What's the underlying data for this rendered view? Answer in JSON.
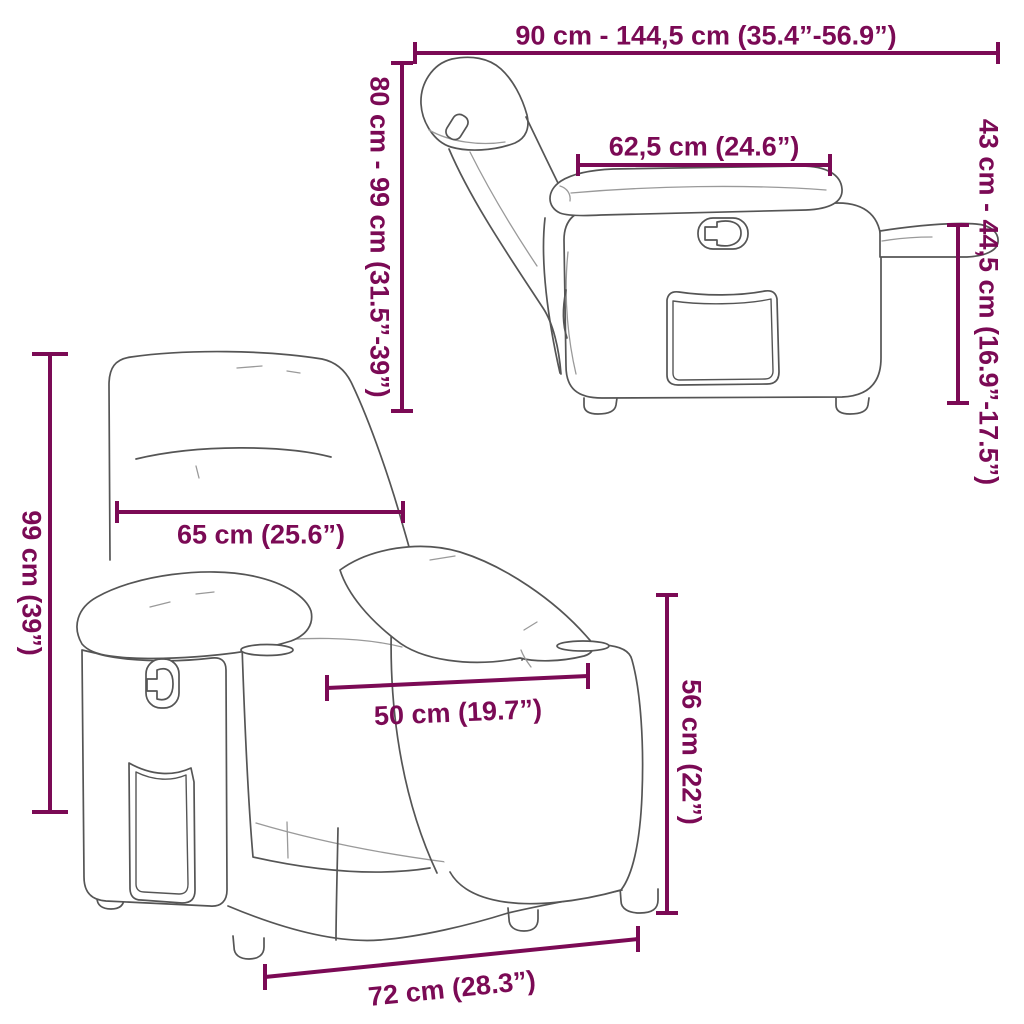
{
  "colors": {
    "accent": "#7B0A55",
    "line_art": "#555555",
    "line_art_light": "#9a9a9a",
    "background": "#FFFFFF"
  },
  "views": {
    "side_reclined": {
      "total_length_label": "90 cm - 144,5 cm (35.4”-56.9”)",
      "backrest_height_label": "80 cm - 99 cm (31.5”-39”)",
      "armrest_depth_label": "62,5 cm (24.6”)",
      "seat_height_label": "43 cm - 44,5 cm (16.9”-17.5”)"
    },
    "front_upright": {
      "total_height_label": "99 cm (39”)",
      "backrest_width_label": "65 cm (25.6”)",
      "seat_width_label": "50 cm (19.7”)",
      "armrest_height_label": "56 cm (22”)",
      "base_width_label": "72 cm (28.3”)"
    }
  }
}
